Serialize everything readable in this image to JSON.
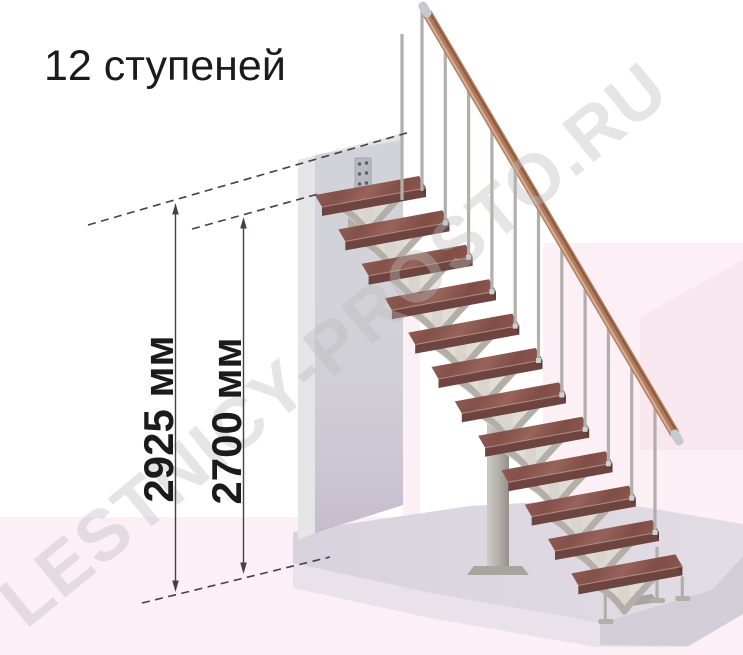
{
  "title": "12 ступеней",
  "watermark": "LESTNICY-PROSTO.RU",
  "annotations": {
    "height_total": "2925 мм",
    "height_flight": "2700 мм"
  },
  "stairs": {
    "steps": 12
  },
  "colors": {
    "background": "#ffffff",
    "pink": "#fceff5",
    "pink_deep": "#f9e7f0",
    "floor_top": "#dbd5df",
    "floor_front": "#e9e2ea",
    "floor_side": "#d3cdd7",
    "wall_front": "#d2d3d8",
    "wall_side": "#e5e5e8",
    "wood_top": "#8e5a52",
    "wood_front": "#6e4440",
    "wood_end": "#5c3a37",
    "wood_highlight": "#c49a8c",
    "metal": "#b3afa8",
    "metal_light": "#ddd8d2",
    "rod": "#b2afab",
    "rail": "#b07a5c",
    "rail_light": "#d4ac92",
    "rail_dark": "#8a573f",
    "cap": "#c6cad0",
    "dimension": "#473f50",
    "text": "#1b1b1b",
    "watermark": "#bcbcbc"
  }
}
